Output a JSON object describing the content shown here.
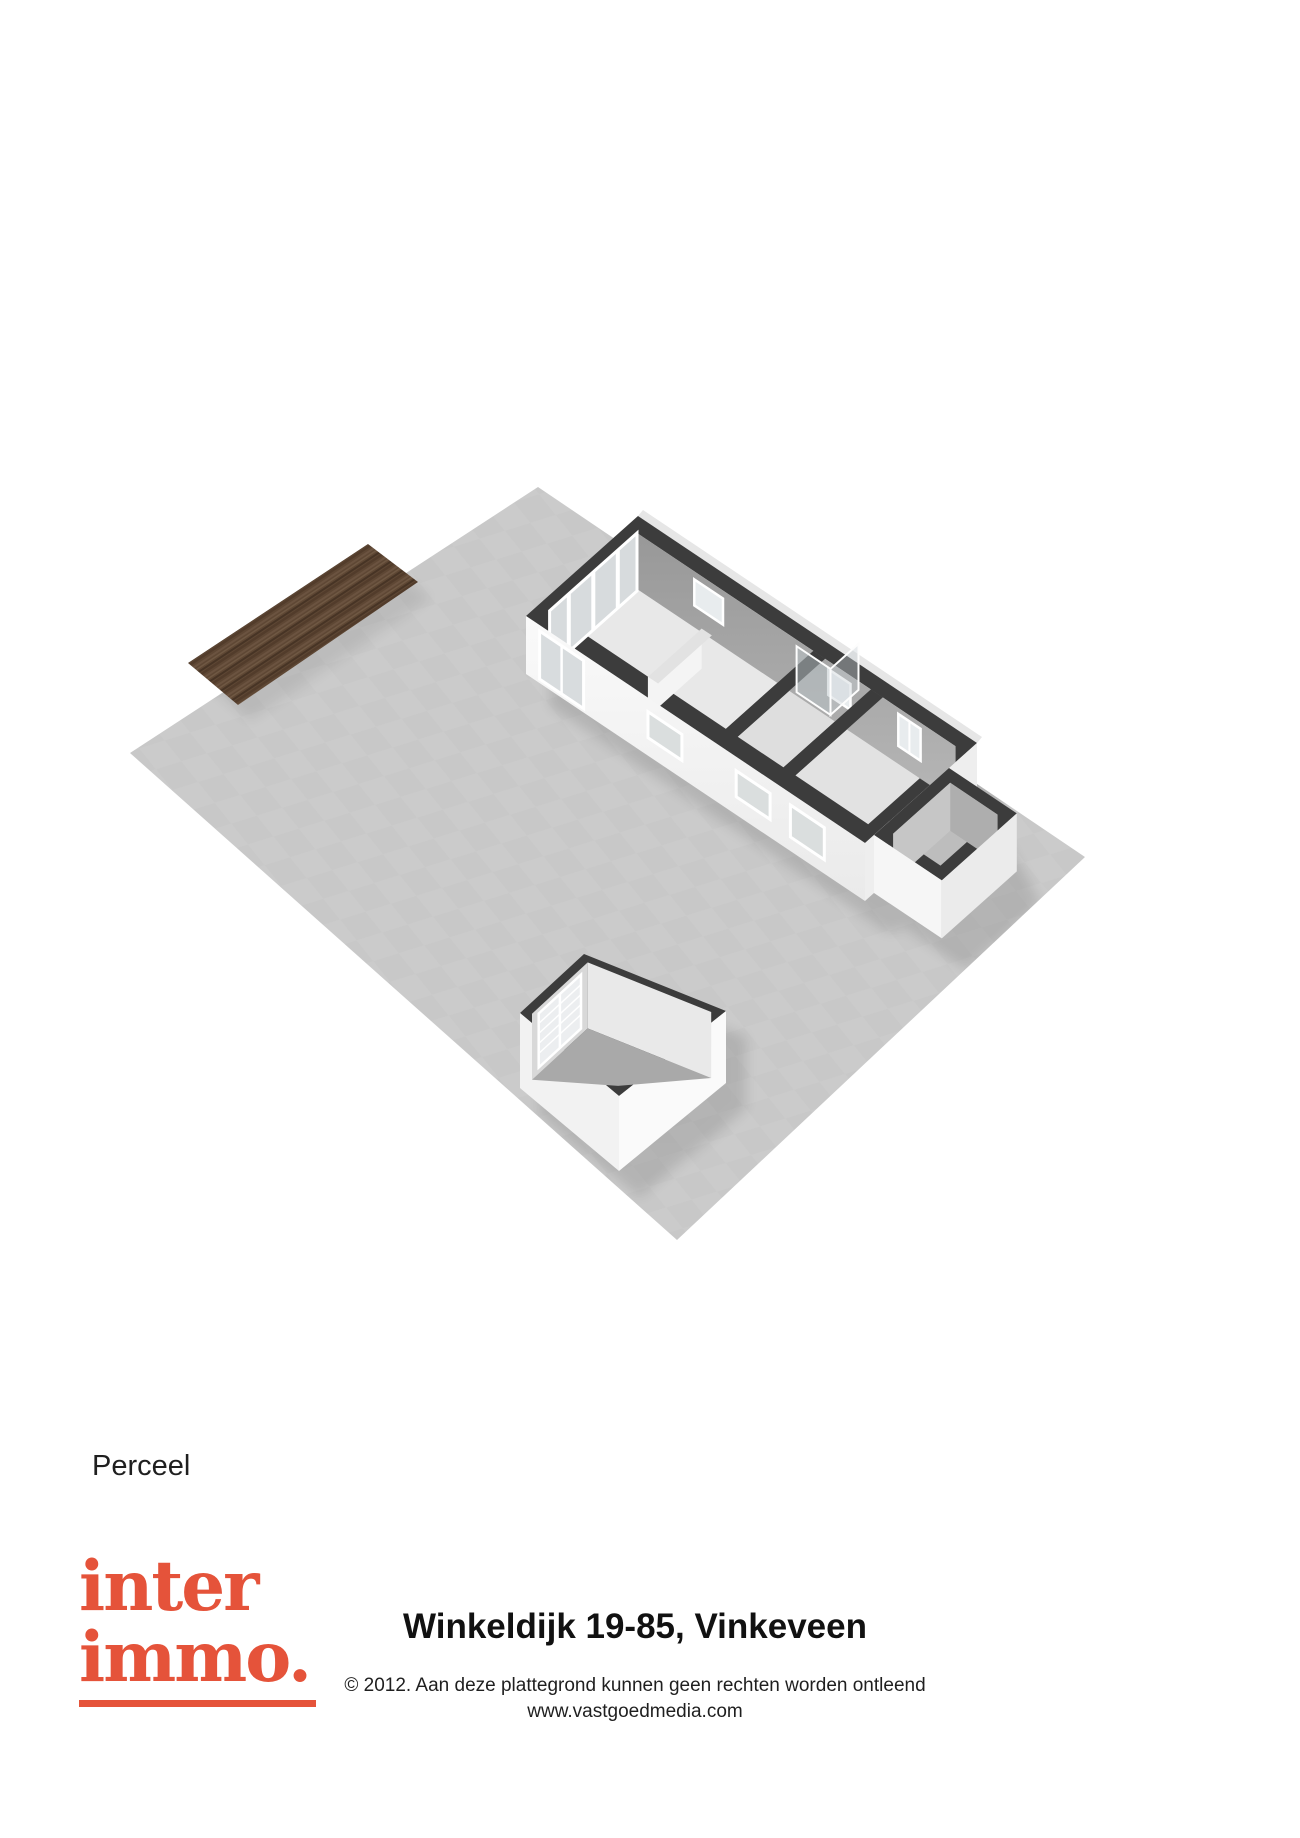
{
  "plan": {
    "label": "Perceel",
    "colors": {
      "parcel": "#c8c8c8",
      "deck_wood": "#5e4734",
      "wall_top": "#3c3c3c",
      "wall_exterior": "#f7f7f7",
      "wall_interior_shaded": "#a2a2a2",
      "floor_light": "#e8e8e8",
      "glass": "#d8dcde",
      "shed_floor": "#a9a9a9"
    }
  },
  "footer": {
    "logo": {
      "line1": "inter",
      "line2": "immo.",
      "color": "#e5533a"
    },
    "title": "Winkeldijk 19-85, Vinkeveen",
    "disclaimer": "© 2012. Aan deze plattegrond kunnen geen rechten worden ontleend",
    "website": "www.vastgoedmedia.com"
  }
}
